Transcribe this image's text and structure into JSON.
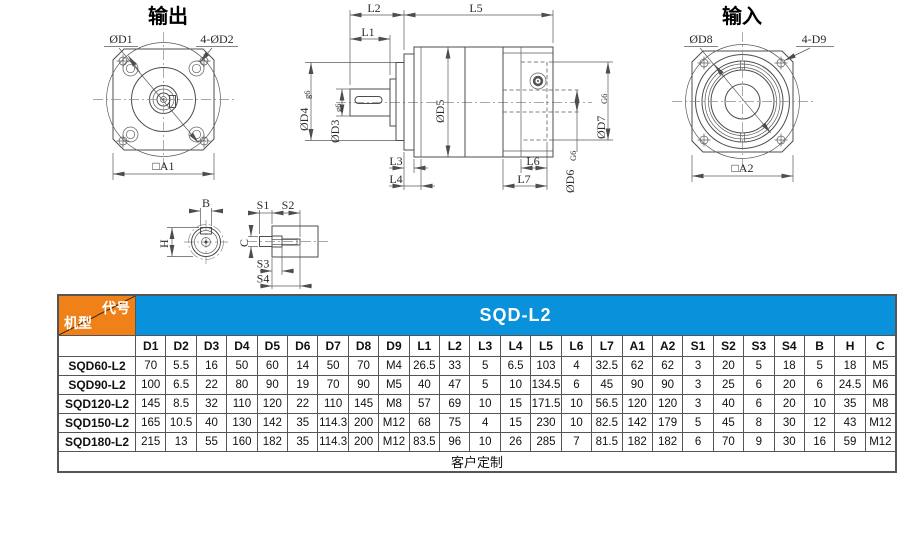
{
  "colors": {
    "orange": "#F08119",
    "blue": "#0991DB",
    "line": "#4d4d4d"
  },
  "drawing": {
    "output_view": {
      "title": "输出",
      "d1": "ØD1",
      "d2": "4-ØD2",
      "a1": "□A1"
    },
    "input_view": {
      "title": "输入",
      "d8": "ØD8",
      "d9": "4-D9",
      "a2": "□A2"
    },
    "side_view": {
      "l1": "L1",
      "l2": "L2",
      "l3": "L3",
      "l4": "L4",
      "l5": "L5",
      "l6": "L6",
      "l7": "L7",
      "d3": "ØD3",
      "d3_tol": "g6",
      "d4": "ØD4",
      "d4_tol": "g6",
      "d5": "ØD5",
      "d6": "ØD6",
      "d6_tol": "G6",
      "d7": "ØD7",
      "d7_tol": "G6"
    },
    "shaft_section": {
      "b": "B",
      "h": "H"
    },
    "shaft_end_section": {
      "s1": "S1",
      "s2": "S2",
      "s3": "S3",
      "s4": "S4",
      "c": "C"
    }
  },
  "table": {
    "corner": {
      "top_right": "代号",
      "bottom_left": "机型"
    },
    "series_title": "SQD-L2",
    "columns": [
      "D1",
      "D2",
      "D3",
      "D4",
      "D5",
      "D6",
      "D7",
      "D8",
      "D9",
      "L1",
      "L2",
      "L3",
      "L4",
      "L5",
      "L6",
      "L7",
      "A1",
      "A2",
      "S1",
      "S2",
      "S3",
      "S4",
      "B",
      "H",
      "C"
    ],
    "rows": [
      {
        "model": "SQD60-L2",
        "values": [
          "70",
          "5.5",
          "16",
          "50",
          "60",
          "14",
          "50",
          "70",
          "M4",
          "26.5",
          "33",
          "5",
          "6.5",
          "103",
          "4",
          "32.5",
          "62",
          "62",
          "3",
          "20",
          "5",
          "18",
          "5",
          "18",
          "M5"
        ]
      },
      {
        "model": "SQD90-L2",
        "values": [
          "100",
          "6.5",
          "22",
          "80",
          "90",
          "19",
          "70",
          "90",
          "M5",
          "40",
          "47",
          "5",
          "10",
          "134.5",
          "6",
          "45",
          "90",
          "90",
          "3",
          "25",
          "6",
          "20",
          "6",
          "24.5",
          "M6"
        ]
      },
      {
        "model": "SQD120-L2",
        "values": [
          "145",
          "8.5",
          "32",
          "110",
          "120",
          "22",
          "110",
          "145",
          "M8",
          "57",
          "69",
          "10",
          "15",
          "171.5",
          "10",
          "56.5",
          "120",
          "120",
          "3",
          "40",
          "6",
          "20",
          "10",
          "35",
          "M8"
        ]
      },
      {
        "model": "SQD150-L2",
        "values": [
          "165",
          "10.5",
          "40",
          "130",
          "142",
          "35",
          "114.3",
          "200",
          "M12",
          "68",
          "75",
          "4",
          "15",
          "230",
          "10",
          "82.5",
          "142",
          "179",
          "5",
          "45",
          "8",
          "30",
          "12",
          "43",
          "M12"
        ]
      },
      {
        "model": "SQD180-L2",
        "values": [
          "215",
          "13",
          "55",
          "160",
          "182",
          "35",
          "114.3",
          "200",
          "M12",
          "83.5",
          "96",
          "10",
          "26",
          "285",
          "7",
          "81.5",
          "182",
          "182",
          "6",
          "70",
          "9",
          "30",
          "16",
          "59",
          "M12"
        ]
      }
    ],
    "footer": "客户定制"
  }
}
